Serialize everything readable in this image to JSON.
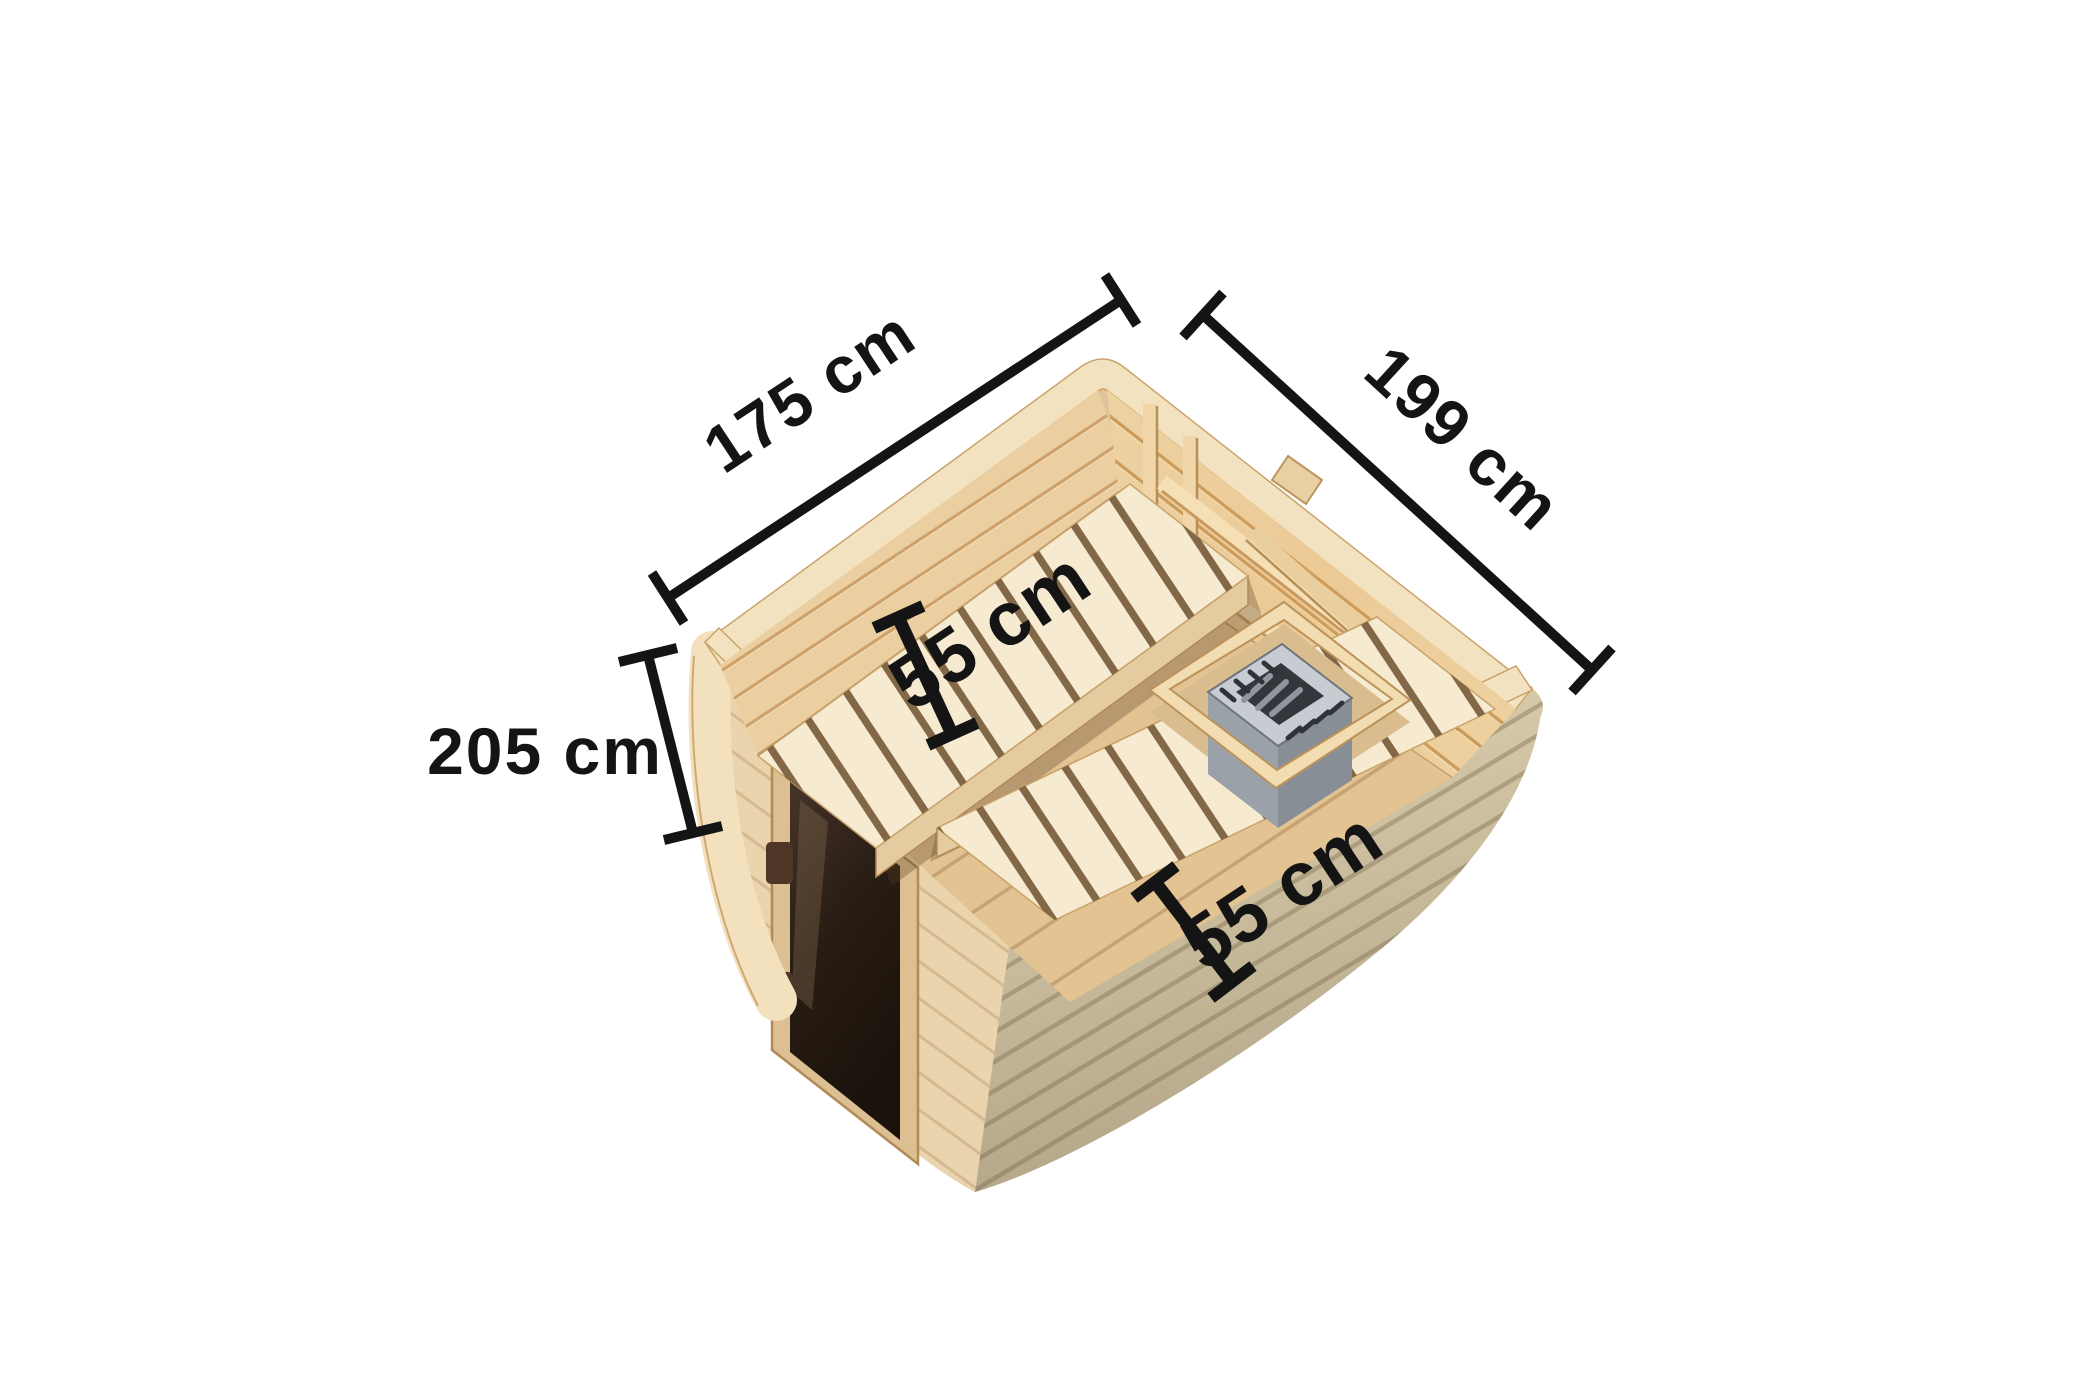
{
  "scene": {
    "background_color": "#ffffff",
    "annotation_color": "#141414",
    "subject": "Wooden cube sauna, top interior view with dimension annotations"
  },
  "dimension_labels": {
    "back_left_width": "175 cm",
    "back_right_depth": "199 cm",
    "front_left_height": "205 cm",
    "upper_bench_depth": "55 cm",
    "lower_bench_depth": "55 cm"
  },
  "palette": {
    "wood_base": "#dfc39a",
    "wood_rim": "#f3e2c0",
    "wood_wall_back_left": "#ebcfa0",
    "wood_wall_back_right": "#edd2a2",
    "wood_floor": "#e3c392",
    "wood_bench": "#f6ead0",
    "wood_bench_skirt": "#e4cba0",
    "wood_exterior_left": "#e9d4ad",
    "wood_exterior_right": "#d5c8a8",
    "wood_corner_post": "#f3e1bd",
    "wood_enclosure": "#f2dcb2",
    "door_glass_dark": "#2a1e15",
    "door_frame": "#dcbf92",
    "door_hinge": "#4e3526",
    "heater_metal_light": "#c6ccd2",
    "heater_metal_mid": "#9aa1a8",
    "heater_metal_dark": "#878e95",
    "heater_interior": "#33373b"
  }
}
